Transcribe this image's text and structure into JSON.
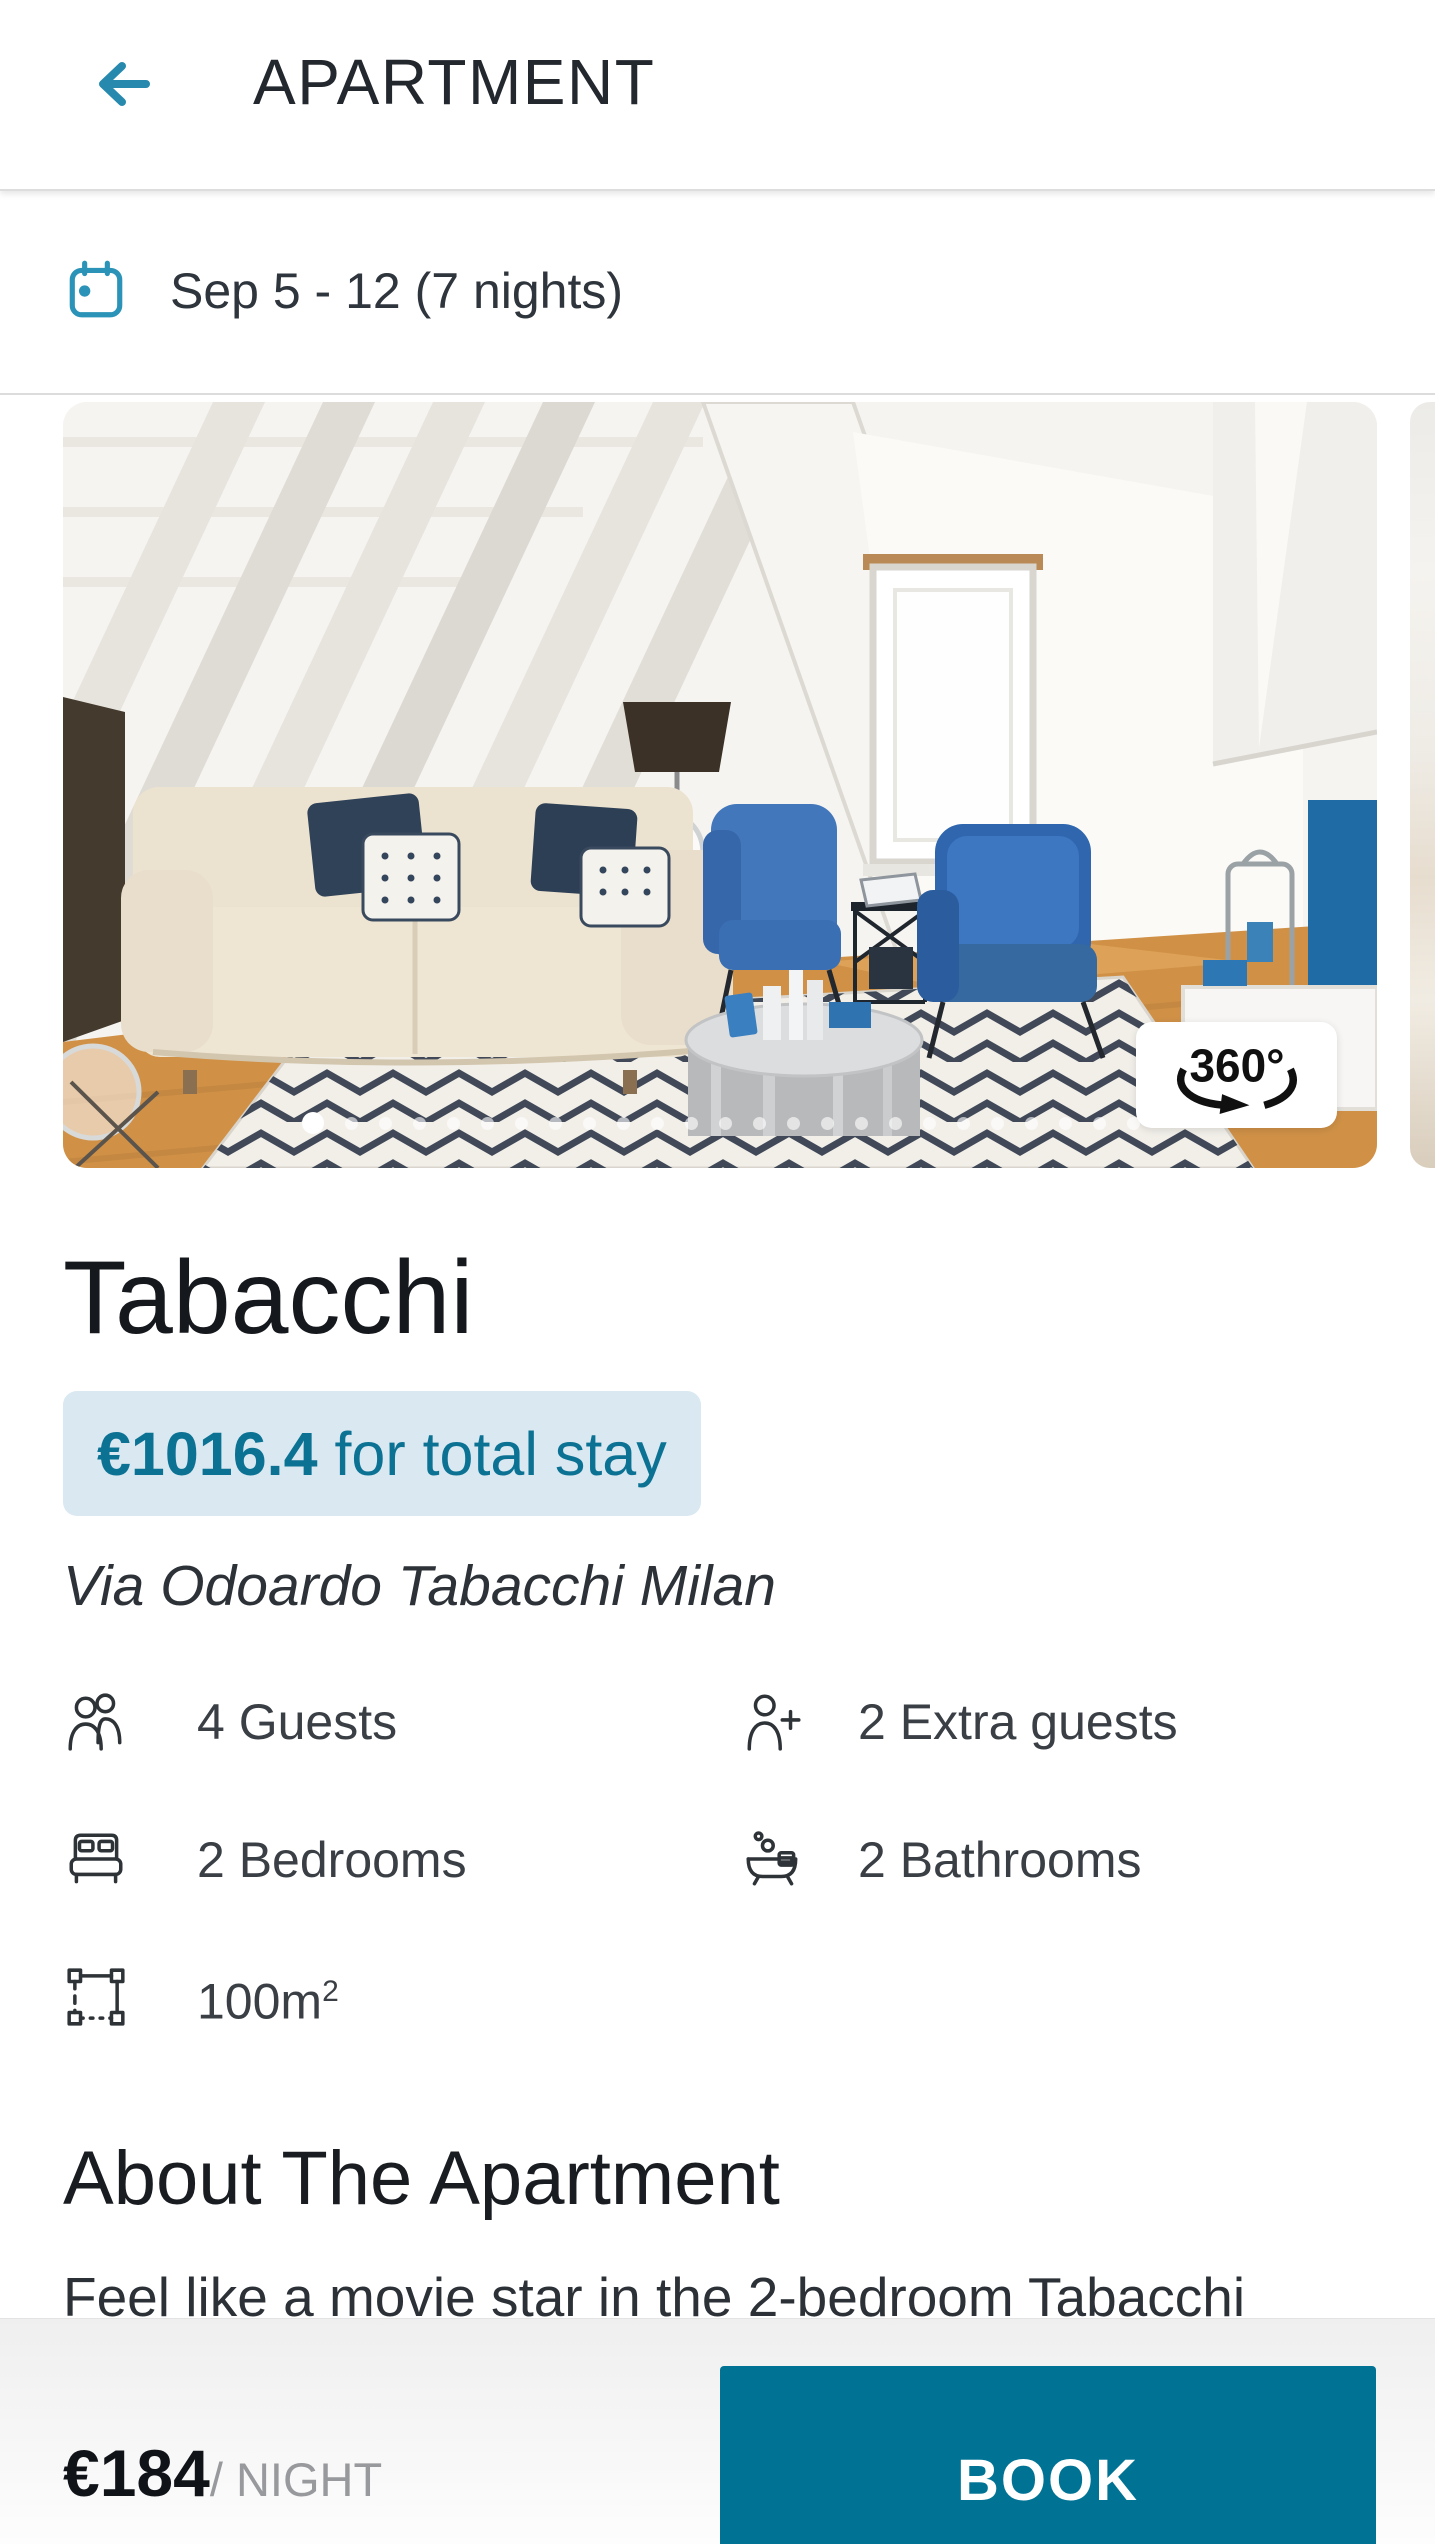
{
  "colors": {
    "accent": "#2789ad",
    "teal_dark": "#0c7294",
    "btn": "#007394",
    "badge_bg": "#d9e8f1"
  },
  "header": {
    "title": "APARTMENT"
  },
  "booking_dates": {
    "text": "Sep 5 - 12 (7 nights)"
  },
  "carousel": {
    "badge_360": "360°",
    "dots_total": 25,
    "active_index": 0
  },
  "listing": {
    "name": "Tabacchi",
    "price_total": "€1016.4",
    "price_total_suffix": " for total stay",
    "address": "Via Odoardo Tabacchi Milan"
  },
  "amenities": {
    "items": [
      {
        "icon": "guests-icon",
        "label": "4 Guests"
      },
      {
        "icon": "extra-guests-icon",
        "label": "2 Extra guests"
      },
      {
        "icon": "bed-icon",
        "label": "2 Bedrooms"
      },
      {
        "icon": "bath-icon",
        "label": "2 Bathrooms"
      },
      {
        "icon": "area-icon",
        "label": "100m",
        "label_sup": "2"
      }
    ]
  },
  "about": {
    "heading": "About The Apartment",
    "text": "Feel like a movie star in the 2-bedroom Tabacchi"
  },
  "footer": {
    "price_per_night": "€184",
    "per_night_label": "/ NIGHT",
    "book_label": "BOOK"
  }
}
